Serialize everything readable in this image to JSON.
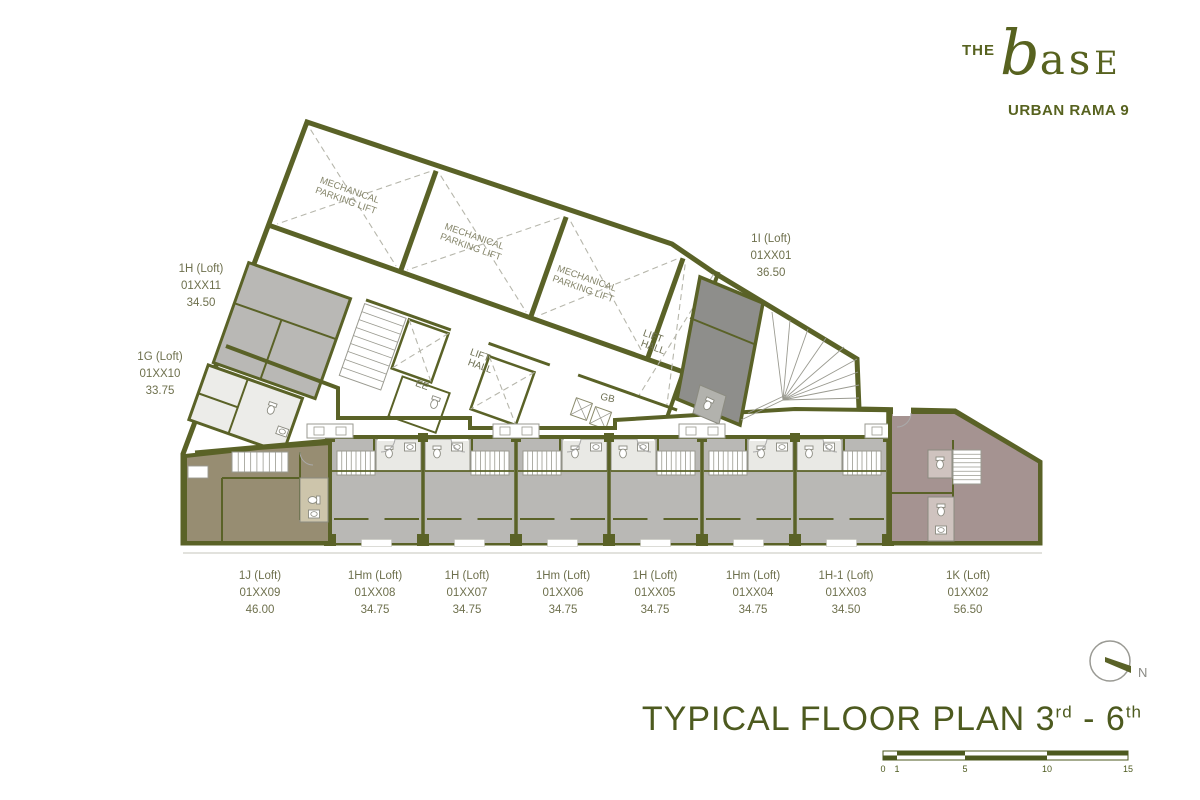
{
  "logo": {
    "the": "THE",
    "name_b": "b",
    "name_as": "as",
    "name_e": "E",
    "subtitle": "URBAN RAMA 9"
  },
  "plan": {
    "mech_bays": [
      {
        "line1": "MECHANICAL",
        "line2": "PARKING LIFT"
      },
      {
        "line1": "MECHANICAL",
        "line2": "PARKING LIFT"
      },
      {
        "line1": "MECHANICAL",
        "line2": "PARKING LIFT"
      }
    ],
    "core_labels": {
      "lift_hall_1": [
        "LIFT",
        "HALL"
      ],
      "lift_hall_2": [
        "LIFT",
        "HALL"
      ],
      "ee": "EE",
      "gb": "GB"
    },
    "side_units": [
      {
        "name": "1H (Loft)",
        "code": "01XX11",
        "area": "34.50"
      },
      {
        "name": "1G (Loft)",
        "code": "01XX10",
        "area": "33.75"
      },
      {
        "name": "1I (Loft)",
        "code": "01XX01",
        "area": "36.50"
      }
    ],
    "bottom_units": [
      {
        "name": "1J (Loft)",
        "code": "01XX09",
        "area": "46.00"
      },
      {
        "name": "1Hm (Loft)",
        "code": "01XX08",
        "area": "34.75"
      },
      {
        "name": "1H (Loft)",
        "code": "01XX07",
        "area": "34.75"
      },
      {
        "name": "1Hm (Loft)",
        "code": "01XX06",
        "area": "34.75"
      },
      {
        "name": "1H (Loft)",
        "code": "01XX05",
        "area": "34.75"
      },
      {
        "name": "1Hm (Loft)",
        "code": "01XX04",
        "area": "34.75"
      },
      {
        "name": "1H-1 (Loft)",
        "code": "01XX03",
        "area": "34.50"
      },
      {
        "name": "1K (Loft)",
        "code": "01XX02",
        "area": "56.50"
      }
    ]
  },
  "title": {
    "main": "TYPICAL FLOOR PLAN ",
    "floor_from": "3",
    "floor_from_sup": "rd",
    "separator": " - ",
    "floor_to": "6",
    "floor_to_sup": "th"
  },
  "scale_bar": {
    "ticks": [
      "0",
      "1",
      "5",
      "10",
      "15"
    ]
  },
  "north": {
    "label": "N"
  },
  "colors": {
    "wall": "#5a6227",
    "unit_gray": "#b9b8b5",
    "unit_dark": "#8e8e8b",
    "unit_taupe": "#978d72",
    "unit_mauve": "#a59391",
    "room_light": "#e9e9e5",
    "label_text": "#6e704d",
    "accent": "#4d5a1f"
  }
}
